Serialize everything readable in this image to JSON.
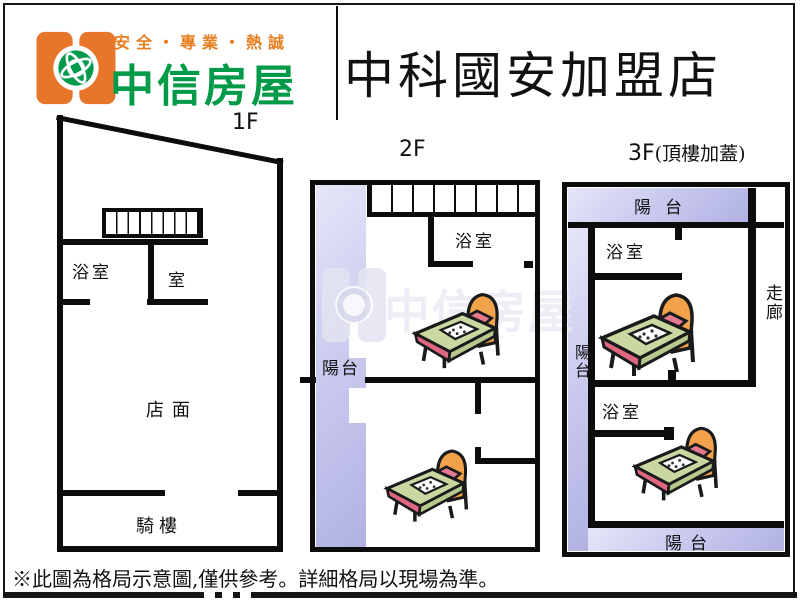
{
  "header": {
    "tagline": "安全・專業・熱誠",
    "brand": "中信房屋",
    "store_title": "中科國安加盟店"
  },
  "floor1": {
    "label": "1F",
    "bathroom": "浴室",
    "room": "室",
    "store": "店面",
    "arcade": "騎樓"
  },
  "floor2": {
    "label": "2F",
    "bathroom": "浴室",
    "balcony": "陽台",
    "beds": 2
  },
  "floor3": {
    "label_prefix": "3F",
    "label_suffix": "(頂樓加蓋)",
    "balcony_top": "陽台",
    "balcony_left": "陽台",
    "balcony_bottom": "陽台",
    "bathroom_upper": "浴室",
    "bathroom_lower": "浴室",
    "corridor": "走廊",
    "beds": 2
  },
  "footer": {
    "disclaimer": "※此圖為格局示意圖,僅供參考。詳細格局以現場為準。"
  },
  "colors": {
    "logo_orange": "#e8762a",
    "tagline_orange": "#e87e1e",
    "brand_green": "#009a48",
    "balcony_lavender": "#c6c6ee",
    "wall_black": "#0c0c0c"
  },
  "icons": {
    "logo": "chinatrust-globe-logo",
    "bed": "bed-clipart",
    "stairs": "stairs-treads",
    "watermark": "ghost-brand-logo"
  }
}
